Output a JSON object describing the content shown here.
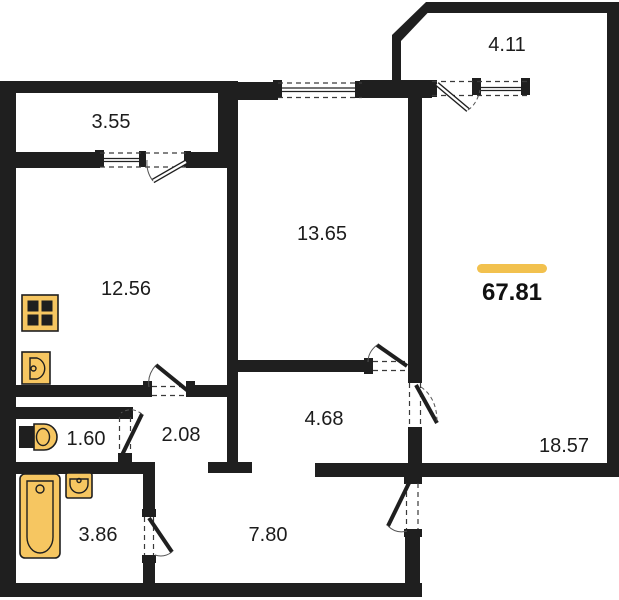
{
  "plan": {
    "title": "apartment-floor-plan",
    "total_area": {
      "value": "67.81"
    },
    "rooms": {
      "balcony_left": {
        "area": "3.55"
      },
      "balcony_right": {
        "area": "4.11"
      },
      "bedroom": {
        "area": "13.65"
      },
      "kitchen": {
        "area": "12.56"
      },
      "living_room": {
        "area": "18.57"
      },
      "wc": {
        "area": "1.60"
      },
      "inner_hall": {
        "area": "2.08"
      },
      "corridor": {
        "area": "4.68"
      },
      "bathroom": {
        "area": "3.86"
      },
      "hallway": {
        "area": "7.80"
      }
    },
    "colors": {
      "wall": "#1f1f1f",
      "accent_bar": "#F2C14E",
      "fixture": "#F6C661"
    },
    "fixtures": [
      "stove-icon",
      "kitchen-sink-icon",
      "toilet-icon",
      "bathtub-icon",
      "washbasin-icon"
    ]
  }
}
